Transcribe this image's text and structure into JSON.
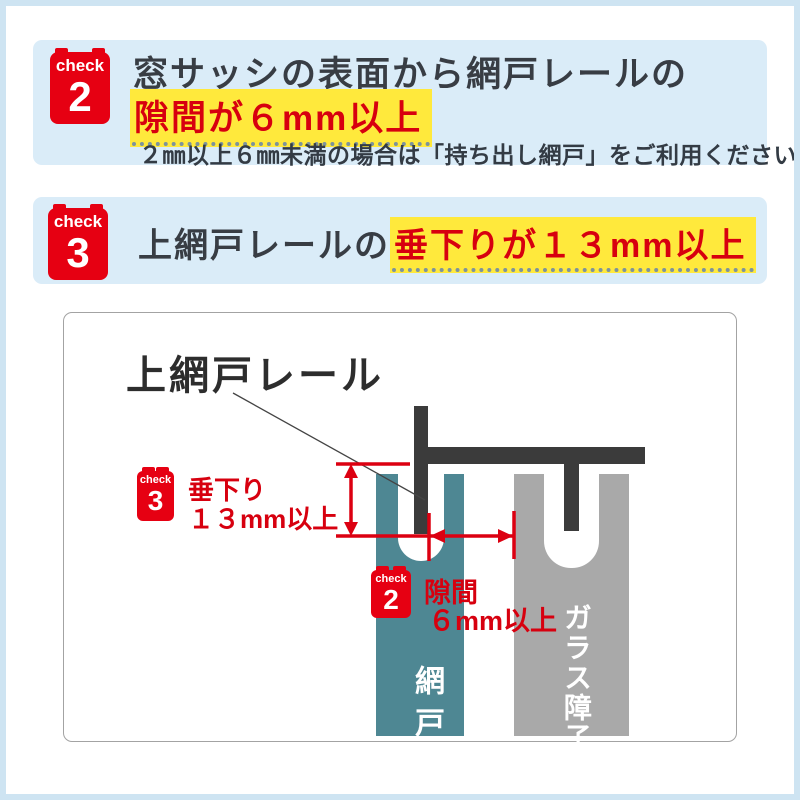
{
  "check2": {
    "badge_label": "check",
    "badge_number": "2",
    "title": "窓サッシの表面から網戸レールの",
    "highlight": "隙間が６mm以上",
    "note": "２㎜以上６㎜未満の場合は「持ち出し網戸」をご利用ください"
  },
  "check3": {
    "badge_label": "check",
    "badge_number": "3",
    "title_prefix": "上網戸レールの",
    "highlight": "垂下りが１３mm以上"
  },
  "diagram": {
    "rail_label": "上網戸レール",
    "sag_callout": {
      "badge_label": "check",
      "badge_number": "3",
      "line1": "垂下り",
      "line2": "１３mm以上"
    },
    "gap_callout": {
      "badge_label": "check",
      "badge_number": "2",
      "line1": "隙間",
      "line2": "６mm以上"
    },
    "screen_door_label": "網戸",
    "glass_shoji_label": "ガラス障子"
  },
  "colors": {
    "accent_red": "#e60012",
    "text_red": "#d7000f",
    "highlight_yellow": "#ffe93c",
    "panel_blue": "#daecf8",
    "frame_blue": "#cee4f2",
    "screen_teal": "#4e8793",
    "glass_gray": "#a9a9a9",
    "rail_dark": "#3b3b3b"
  }
}
